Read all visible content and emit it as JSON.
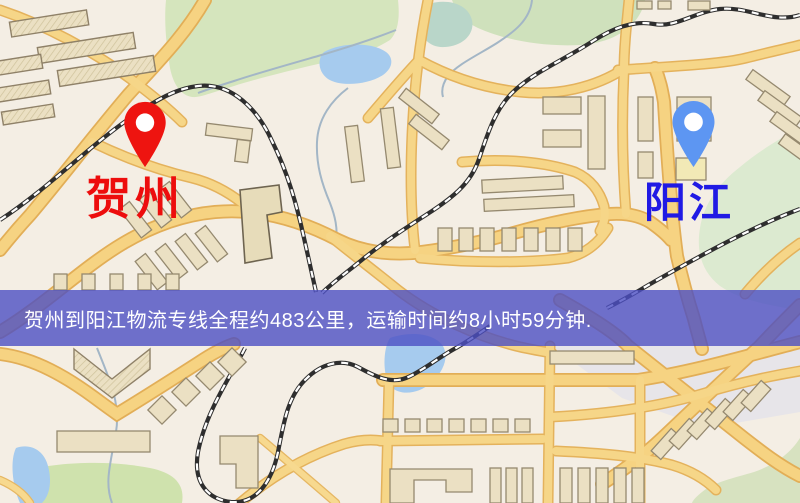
{
  "map": {
    "origin": {
      "label": "贺州",
      "label_color": "#ed0d0d",
      "pin_color": "#ee1410",
      "pin_icon": "red-map-pin"
    },
    "destination": {
      "label": "阳江",
      "label_color": "#201ae4",
      "pin_color": "#5d96f2",
      "pin_icon": "blue-map-pin"
    },
    "banner": {
      "text": "贺州到阳江物流专线全程约483公里，运输时间约8小时59分钟.",
      "background_color": "#4c4fc3",
      "text_color": "#ffffff"
    },
    "route": {
      "from": "贺州",
      "to": "阳江",
      "distance_text": "约483公里",
      "duration_text": "约8小时59分钟"
    },
    "palette": {
      "background": "#f4eee4",
      "road": "#f6d382",
      "road_casing": "#e2ae57",
      "building": "#ebe0c3",
      "park_green": "#d5e5bd",
      "water": "#a6cbee",
      "railway": "#2e2e2e"
    }
  }
}
